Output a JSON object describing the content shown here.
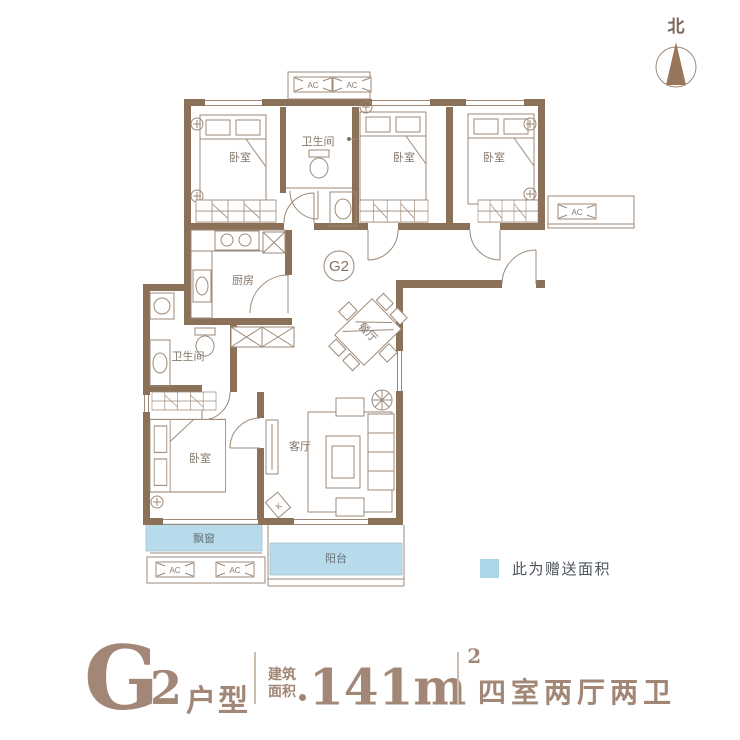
{
  "compass": {
    "north": "北"
  },
  "plan": {
    "badge": "G2",
    "ac": "AC",
    "door_code": "K",
    "rooms": {
      "bedroom1": "卧室",
      "bedroom2": "卧室",
      "bedroom3": "卧室",
      "bedroom4": "卧室",
      "bathroom1": "卫生间",
      "bathroom2": "卫生间",
      "kitchen": "厨房",
      "dining": "餐厅",
      "living": "客厅",
      "bay_window": "飘窗",
      "balcony": "阳台"
    },
    "colors": {
      "wall": "#8a7158",
      "gift_area": "#b7dbea",
      "line": "#9d8977"
    }
  },
  "legend": {
    "text": "此为赠送面积",
    "swatch_color": "#a9d6e8"
  },
  "title": {
    "letter": "G",
    "number": "2",
    "suffix": "户型",
    "area_line1": "建筑",
    "area_line2": "面积",
    "area_number": "141",
    "area_unit": "m",
    "area_sup": "2",
    "layout": "四室两厅两卫"
  }
}
